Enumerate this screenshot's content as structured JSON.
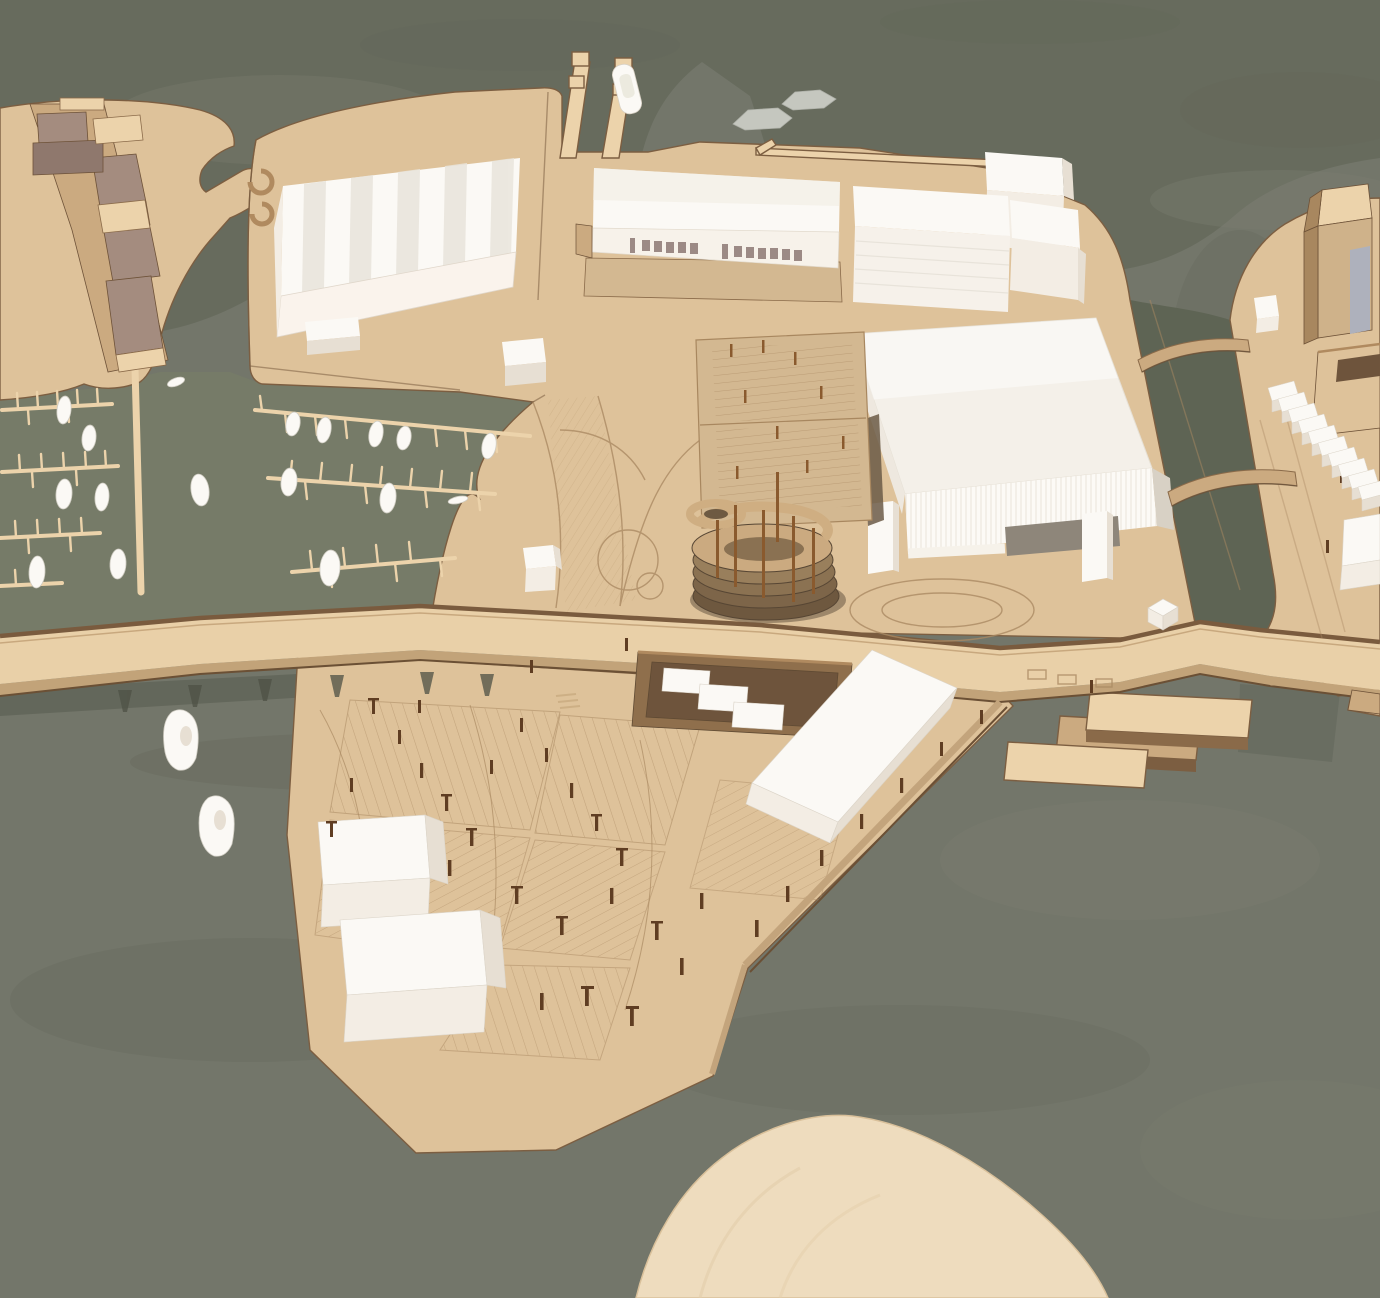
{
  "meta": {
    "subject": "Aerial photograph of a wooden architectural scale model of a waterfront harbour masterplan",
    "materials": [
      "laser-cut plywood baseboard",
      "white card building volumes",
      "sage-painted water plane"
    ]
  },
  "colors": {
    "water_open": "#73766a",
    "water_top": "#676b5d",
    "water_light_patch": "#7b7e70",
    "water_dark_patch": "#64685a",
    "water_marina": "#798066",
    "water_canal": "#5e6454",
    "water_shadow": "#54584b",
    "wood_light": "#ecd3ab",
    "wood": "#dec29a",
    "wood_mid": "#cbaa80",
    "wood_deck": "#d3b891",
    "wood_dark": "#a8875f",
    "wood_edge": "#7c5e41",
    "wood_deep": "#5f4a33",
    "mauve_roof": "#a48c7f",
    "mauve_face": "#8f786d",
    "white_top": "#fbf9f5",
    "white_face": "#f3ede4",
    "white_shade": "#e7dfd3",
    "white_dim": "#d8d1c5",
    "window": "#9c8a85",
    "opening_dark": "#8e867a",
    "gray_blue": "#aeb1bc",
    "gray_boat": "#c5c7bf",
    "post": "#5f3d22",
    "rust_post": "#8a5a2e",
    "etch": "#ab8a63",
    "island": "#eedcbe"
  },
  "scene": {
    "areas": [
      {
        "id": "left-landmass",
        "label": "north-west quay with stepped waterfront building row"
      },
      {
        "id": "marina",
        "label": "two marina basins with finger docks and moored boats"
      },
      {
        "id": "central-landmass",
        "label": "main harbour plate with warehouses, office block, arena and parking structures"
      },
      {
        "id": "bridge-road",
        "label": "curved road bridge crossing the water and the site"
      },
      {
        "id": "peninsula",
        "label": "southern peninsula with etched parking lots, lamp posts and white storage volumes"
      },
      {
        "id": "right-pier",
        "label": "eastern pier with silo tower, courtyard block and terraced white houses"
      },
      {
        "id": "canal",
        "label": "canal with two arched timber footbridges"
      },
      {
        "id": "bottom-island",
        "label": "plain plywood cape entering from the bottom edge"
      }
    ],
    "counts": {
      "marina_boats": 17,
      "open_water_boats": 2,
      "gray_barges": 2,
      "terraced_houses": 10,
      "canal_bridges": 2,
      "white_massing_volumes": 12
    }
  }
}
